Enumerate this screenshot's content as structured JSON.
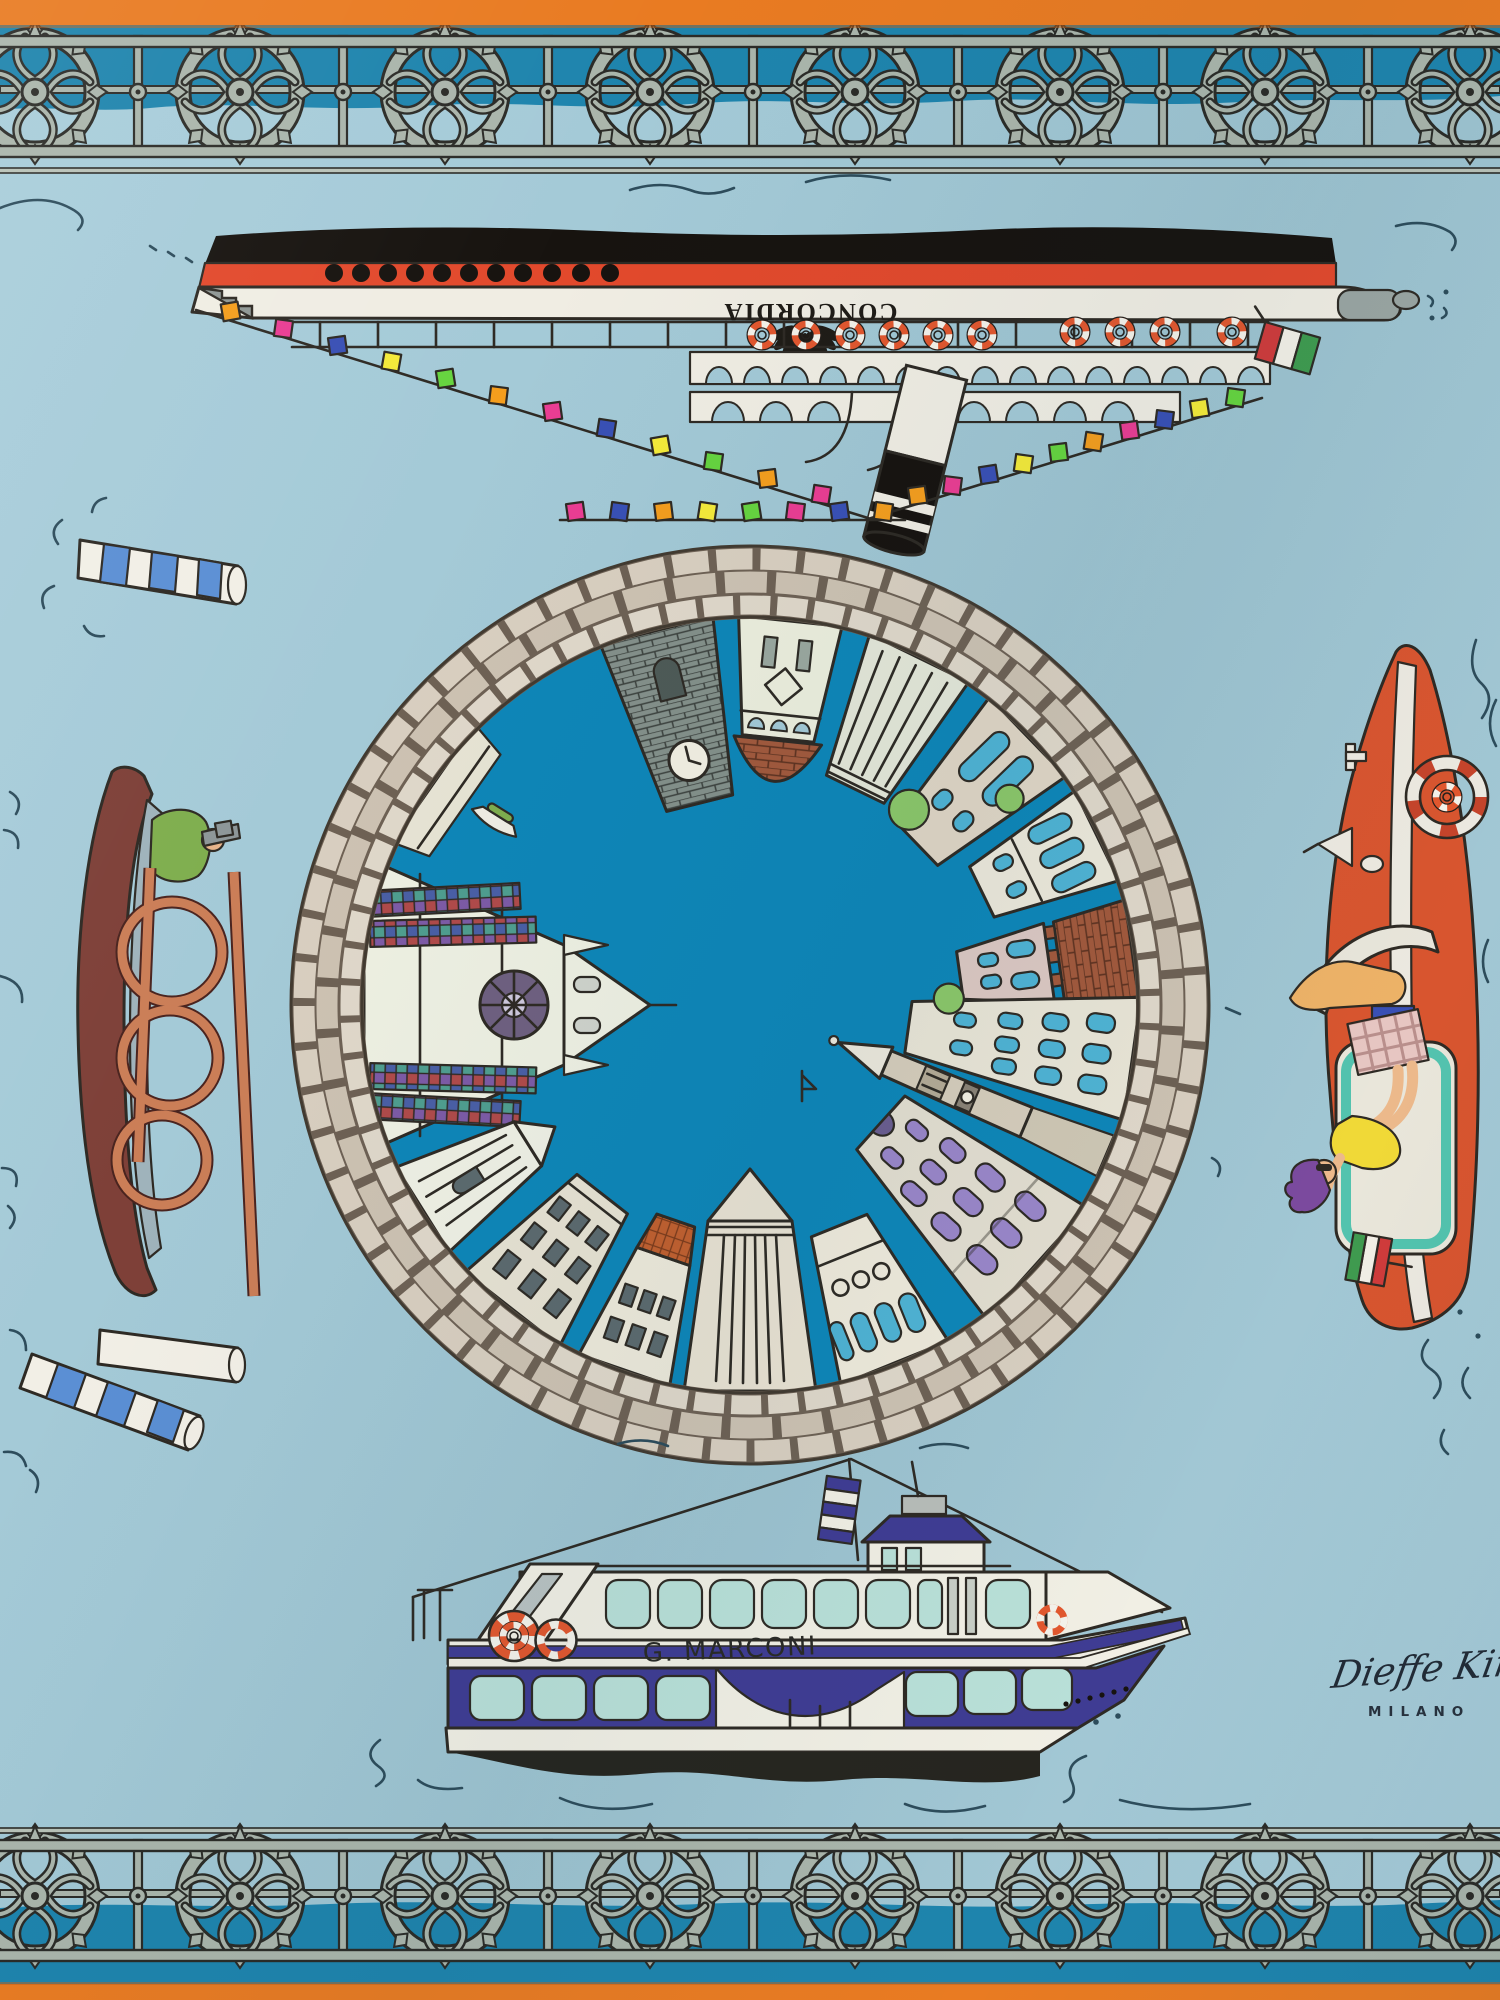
{
  "artwork": {
    "kind": "photograph of a printed silk scarf",
    "theme": "Venice: circular fisheye cityscape medallion surrounded by lagoon boats"
  },
  "texts": {
    "cruise_ship_name": "CONCORDIA",
    "ferry_name": "G. MARCONI",
    "signature": "Dieffe Kinloch",
    "signature_city": "MILANO"
  },
  "palette": {
    "background_blue": "#a3c9d6",
    "border_orange": "#e97b22",
    "band_teal": "#1e84ad",
    "center_water_teal": "#0e86b8",
    "railing_metal": "#aab5ab",
    "stone_light": "#d9cfc0",
    "stone_mid": "#cdc2b2",
    "stone_mortar": "#6e6154",
    "ship_red": "#e2492c",
    "ship_black": "#17130f",
    "ferry_navy": "#3f3c93",
    "window_teal": "#b9e0d8",
    "speedboat_orange": "#d8552f",
    "gondola_brown": "#7e4038",
    "copper_rail": "#cb7e57",
    "flag_colors": [
      "#f59e1d",
      "#ea3d93",
      "#3950b5",
      "#f4ea39",
      "#66d43f"
    ],
    "italian_flag": [
      "#cf3b3b",
      "#f2efe6",
      "#3f9b4f"
    ]
  }
}
